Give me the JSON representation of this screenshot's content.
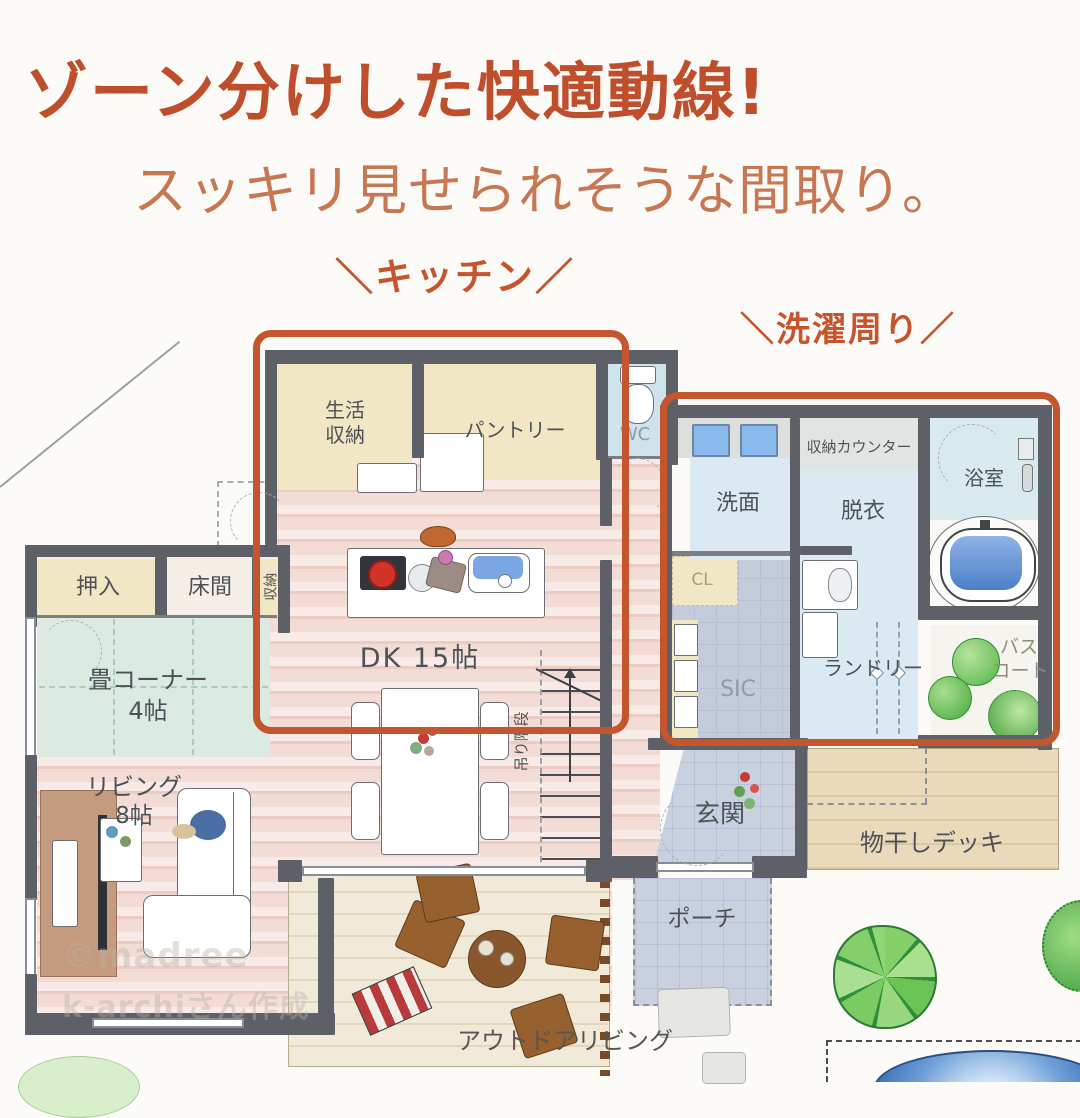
{
  "header": {
    "title": "ゾーン分けした快適動線!",
    "subtitle": "スッキリ見せられそうな間取り。"
  },
  "zone_labels": {
    "kitchen": "＼キッチン／",
    "laundry": "＼洗濯周り／"
  },
  "rooms": {
    "seikatsu_shuno": "生活\n収納",
    "pantry": "パントリー",
    "wc": "WC",
    "senmen": "洗面",
    "shuno_counter": "収納カウンター",
    "datsui": "脱衣",
    "yokushitsu": "浴室",
    "cl": "CL",
    "oshiire": "押入",
    "tokonoma": "床間",
    "shuno": "収納",
    "dk": "DK 15帖",
    "tatami1": "畳コーナー",
    "tatami2": "4帖",
    "stairs": "吊り階段",
    "sic": "SIC",
    "laundry": "ランドリー",
    "bath_court1": "バス",
    "bath_court2": "コート",
    "living1": "リビング",
    "living2": "8帖",
    "genkan": "玄関",
    "porch": "ポーチ",
    "monohoshi_deck": "物干しデッキ",
    "outdoor_living": "アウトドアリビング"
  },
  "watermark": {
    "line1": "©madree",
    "line2": "k-archiさん作成"
  },
  "colors": {
    "accent_orange": "#c4552d",
    "title_orange": "#bf4f2c",
    "subtitle_orange": "#c87753",
    "wall_gray": "#5d6167"
  }
}
